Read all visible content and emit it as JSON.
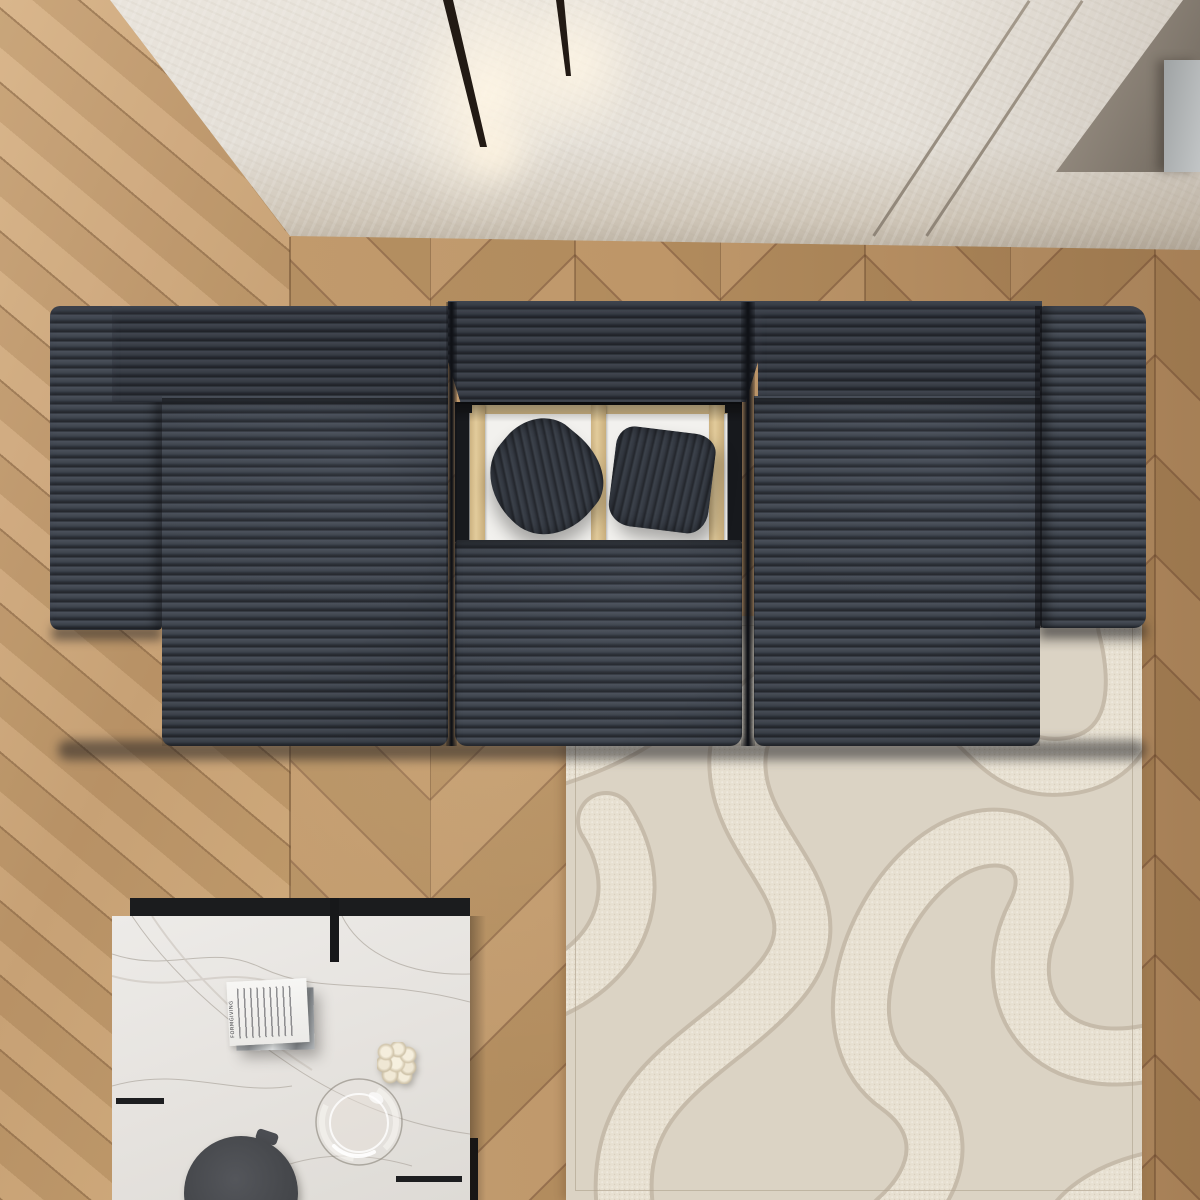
{
  "scene": {
    "description": "top-down 3d render of a living room",
    "ceiling": {
      "label": "plaster ceiling",
      "color": "#e6e1d8",
      "recess_color": "#7d7469",
      "panel_color": "#b4b7b8",
      "light_fixtures": 2,
      "light_color": "#221a14",
      "glow_color": "#fff3dd"
    },
    "floor": {
      "label": "oak chevron parquet",
      "light_tone": "#c8a274",
      "dark_tone": "#8f6a46",
      "left_area": "diagonal planks",
      "seam_x": 290
    },
    "sofa": {
      "label": "dark corduroy modular sofa",
      "fabric_color": "#3a3f48",
      "stripe_color": "#262a30",
      "sections": [
        "left armrest",
        "left seat",
        "center ottoman",
        "right seat",
        "right armrest"
      ],
      "pillow_count": 2,
      "pillow_color": "#2f343b",
      "frame": {
        "platform_color": "#f2f1ee",
        "rail_color": "#dbc394"
      }
    },
    "rug": {
      "label": "cream sculpted wave rug",
      "base_color": "#dbd3c4",
      "band_color": "#e7e0d1",
      "line_color": "#c6bbaa"
    },
    "coffee_table": {
      "label": "marble top coffee table",
      "marble_color": "#eae8e5",
      "tier_color": "#1b1c1e",
      "items": [
        "book stack",
        "bubble candle",
        "glass carafe",
        "stone stool"
      ]
    },
    "stool": {
      "color": "#47494d"
    },
    "candle": {
      "color": "#efe7d6"
    },
    "glass": {
      "label": "round glass carafe"
    }
  },
  "book": {
    "spine_text": "FORMGIVING",
    "cover_color": "#f4f3f1",
    "under_book_color": "#a7abae"
  }
}
